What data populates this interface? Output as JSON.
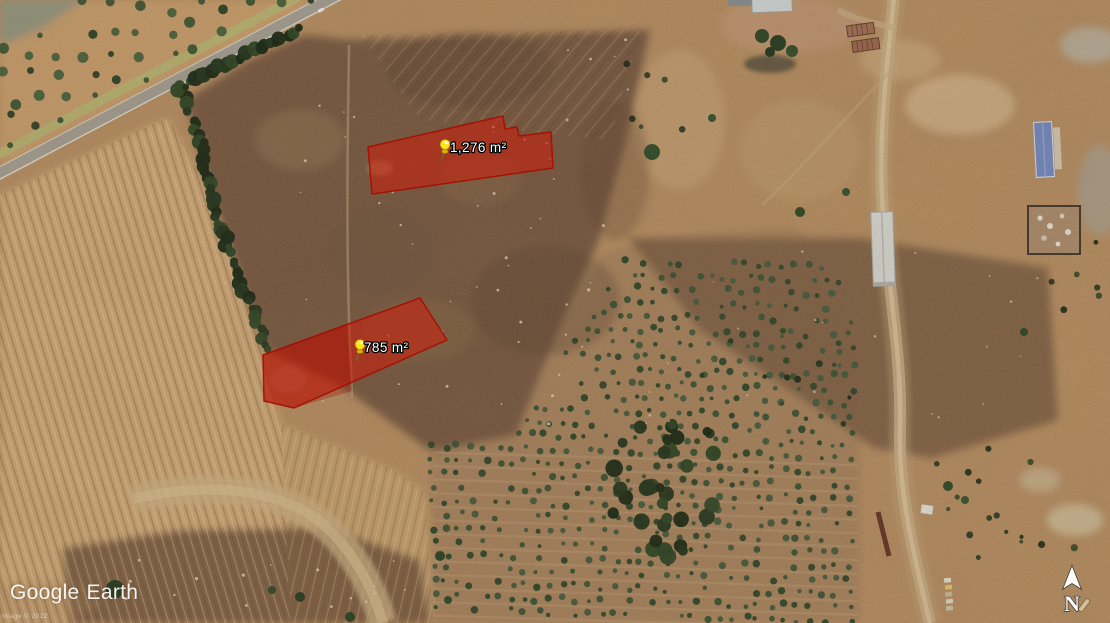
{
  "branding": {
    "google": "Google",
    "earth": "Earth",
    "attribution": "Image © 2022"
  },
  "map": {
    "overlay_fill": "rgba(206,28,10,0.55)",
    "overlay_stroke": "rgba(168,12,0,0.9)",
    "pin_head_color": "#ffe414",
    "label_text_color": "#ffffff",
    "label_outline_color": "#000000",
    "parcels": [
      {
        "area_label": "1,276 m²",
        "area_value_m2": 1276,
        "points": "368,147 503,116 505,129 517,127 519,136 551,132 553,168 372,194",
        "pin_transform": "translate(441,161)"
      },
      {
        "area_label": "785 m²",
        "area_value_m2": 785,
        "points": "263,355 420,298 447,340 294,408 264,401",
        "pin_transform": "translate(356,361)"
      }
    ]
  },
  "compass": {
    "label": "N"
  }
}
